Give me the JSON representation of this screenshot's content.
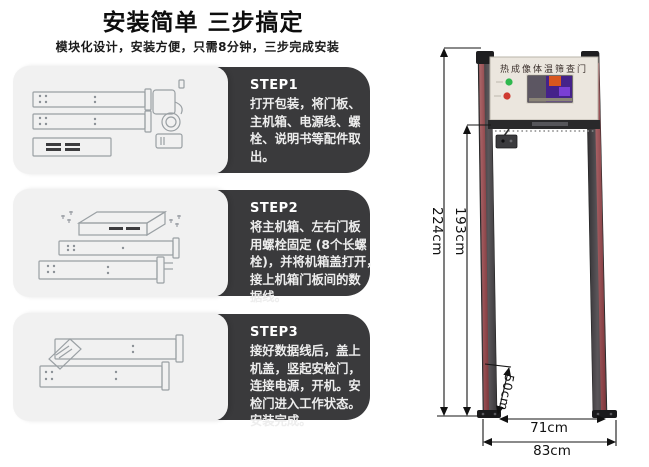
{
  "header": {
    "title": "安装简单 三步搞定",
    "subtitle": "模块化设计，安装方便，只需8分钟，三步完成安装"
  },
  "steps": [
    {
      "label": "STEP1",
      "lines": [
        "打开包装，将门板、",
        "主机箱、电源线、螺",
        "栓、说明书等配件取",
        "出。"
      ]
    },
    {
      "label": "STEP2",
      "lines": [
        "将主机箱、左右门板",
        "用螺栓固定 (8个长螺",
        "栓)，并将机箱盖打开，",
        "接上机箱门板间的数",
        "据线。"
      ]
    },
    {
      "label": "STEP3",
      "lines": [
        "接好数据线后，盖上",
        "机盖，竖起安检门，",
        "连接电源，开机。安",
        "检门进入工作状态。",
        "安装完成。"
      ]
    }
  ],
  "gate": {
    "panel_title": "热成像体温筛查门",
    "dimensions": {
      "outer_height": "224cm",
      "inner_height": "193cm",
      "foot_section": "50cm",
      "inner_width": "71cm",
      "outer_width": "83cm"
    },
    "colors": {
      "card_dark": "#3a3a3c",
      "card_light": "#f1f1f1",
      "post_gray": "#4a484b",
      "stripe_red": "#9a4448",
      "panel_face": "#ebe6de",
      "indicator_green": "#2fb84e",
      "indicator_red": "#cf3a30"
    }
  }
}
